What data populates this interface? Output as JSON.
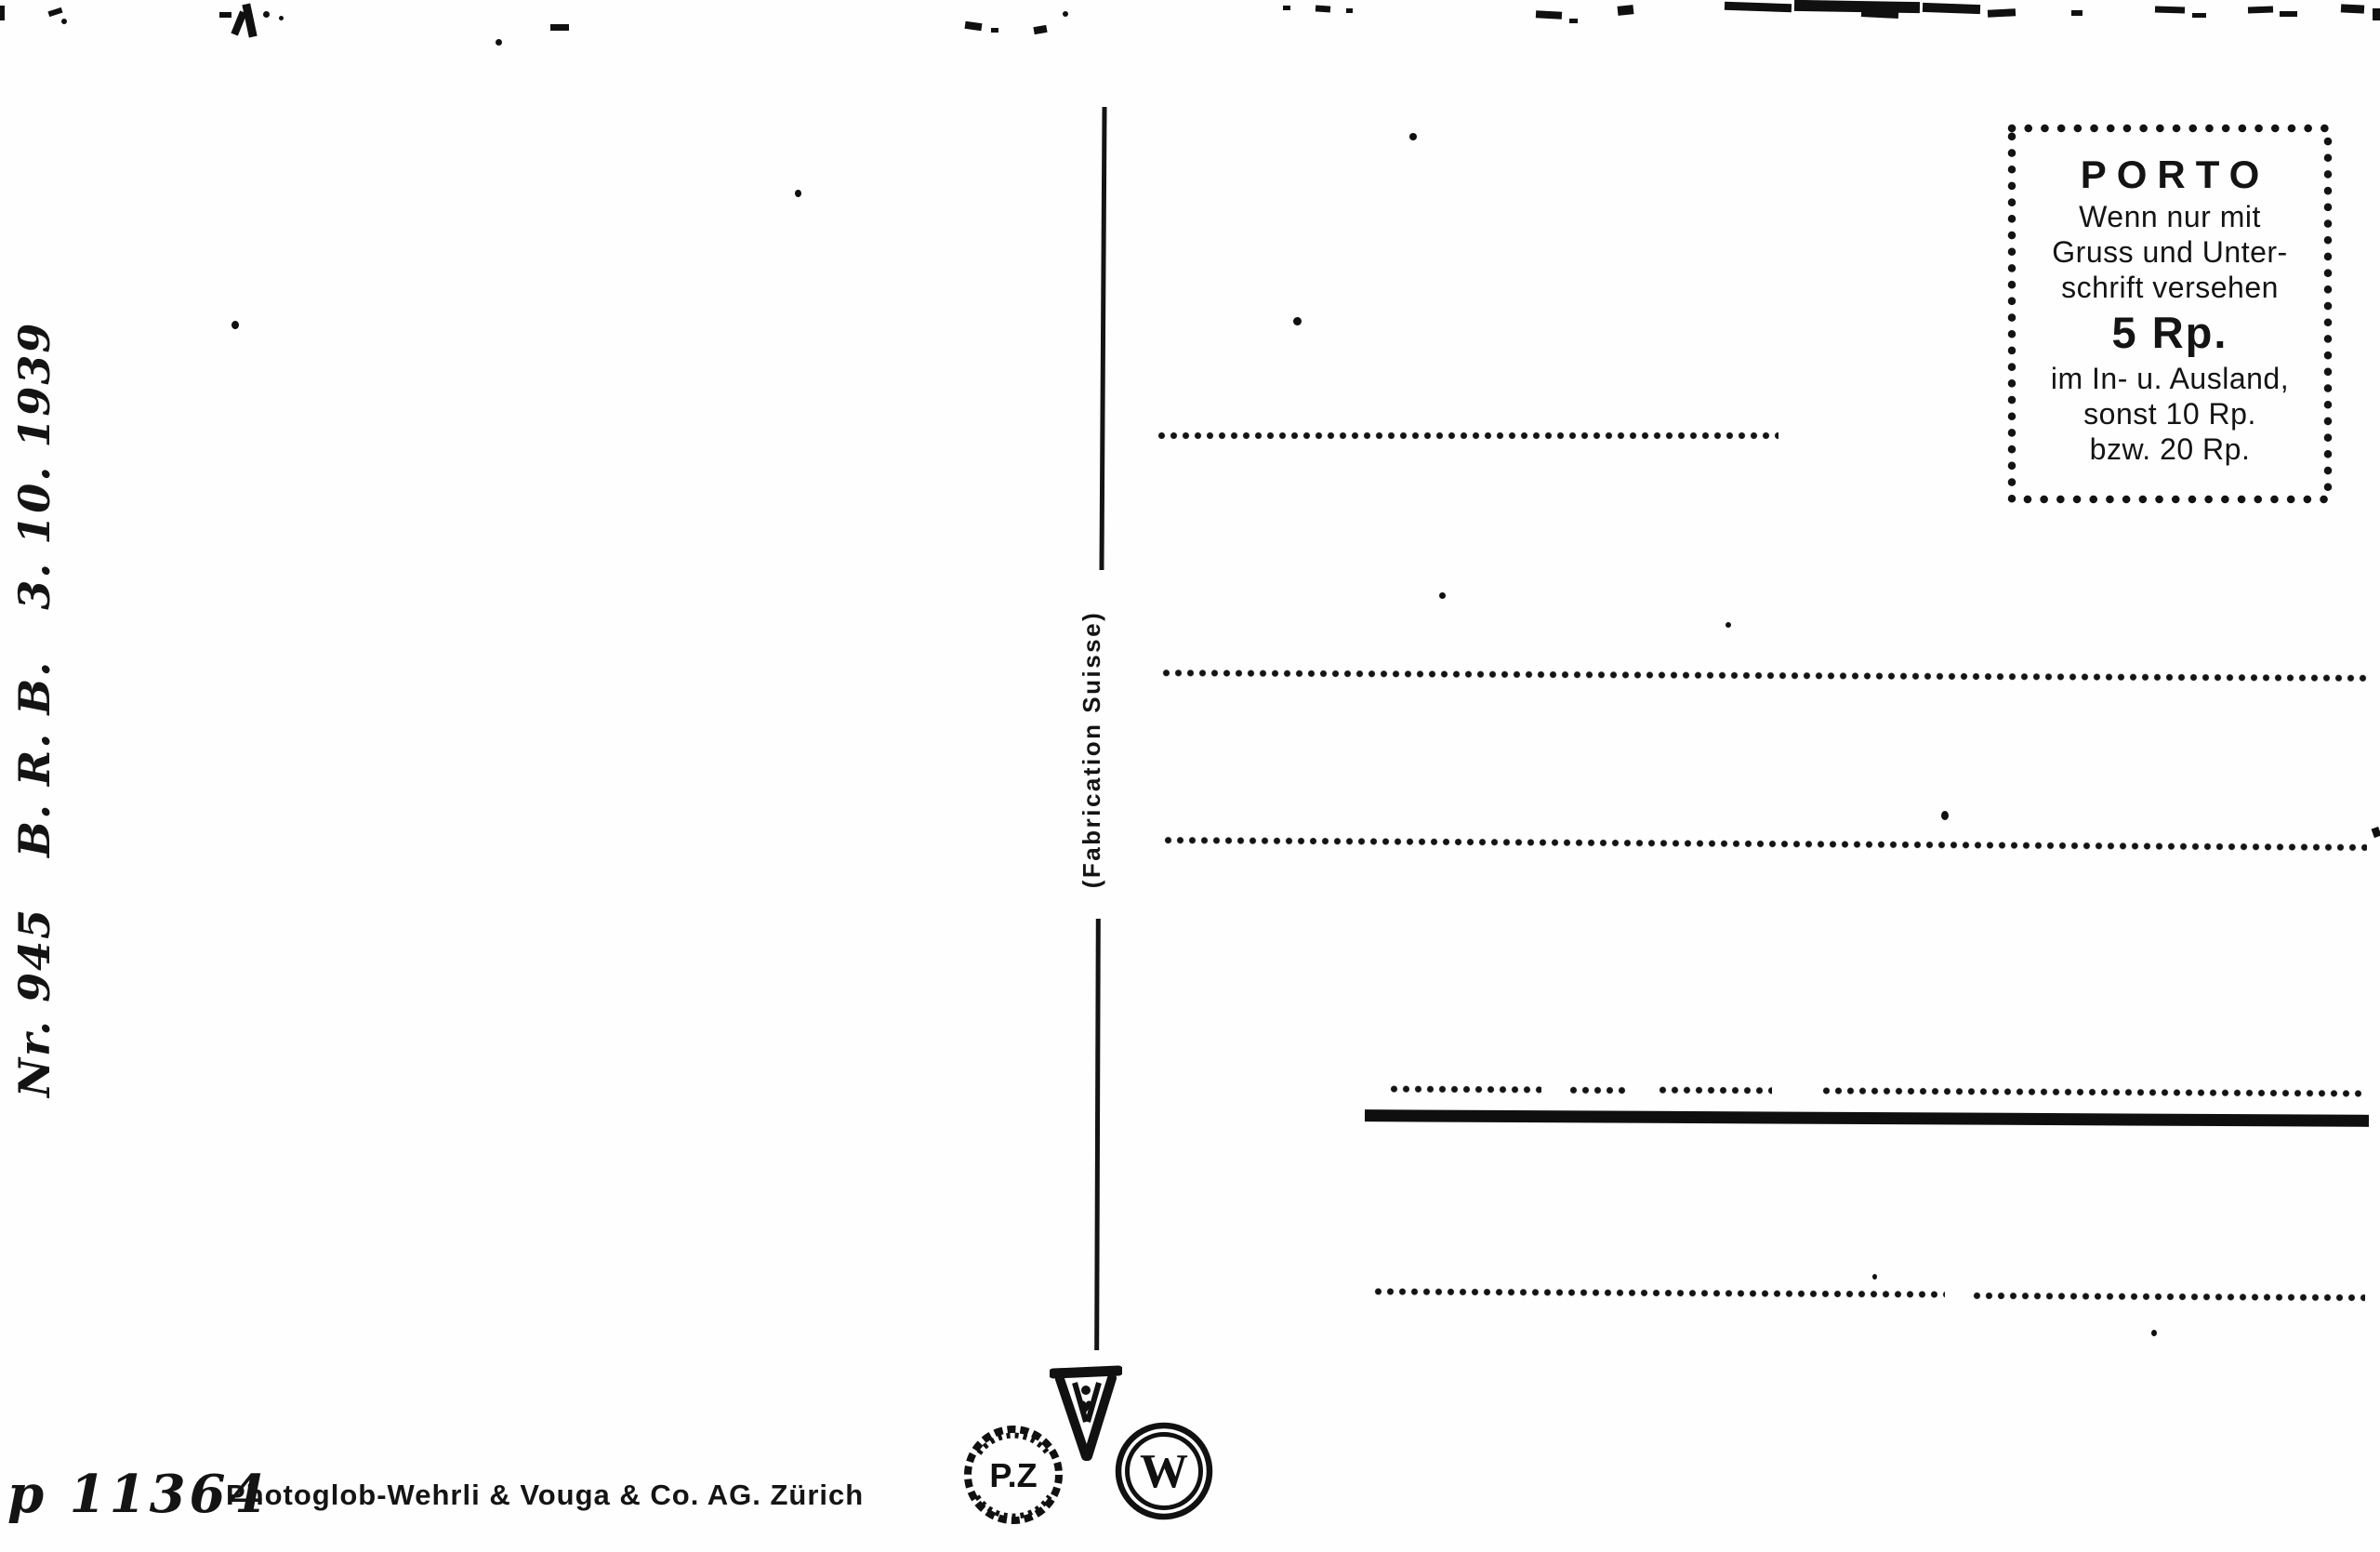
{
  "postcard": {
    "reference_vertical": "Nr. 945   B. R. B.   3. 10. 1939",
    "fabrication_vertical": "(Fabrication Suisse)",
    "porto_box": {
      "title": "PORTO",
      "body": [
        "Wenn nur mit",
        "Gruss und Unter-",
        "schrift versehen"
      ],
      "rate": "5 Rp.",
      "footer": [
        "im In- u. Ausland,",
        "sonst 10 Rp.",
        "bzw. 20 Rp."
      ]
    },
    "imprint": {
      "number": "p 11364",
      "publisher": "Photoglob-Wehrli & Vouga & Co. AG. Zürich"
    },
    "logos": {
      "pz": "P.Z",
      "w": "W"
    },
    "colors": {
      "ink": "#141414",
      "paper": "#fefefe"
    }
  }
}
